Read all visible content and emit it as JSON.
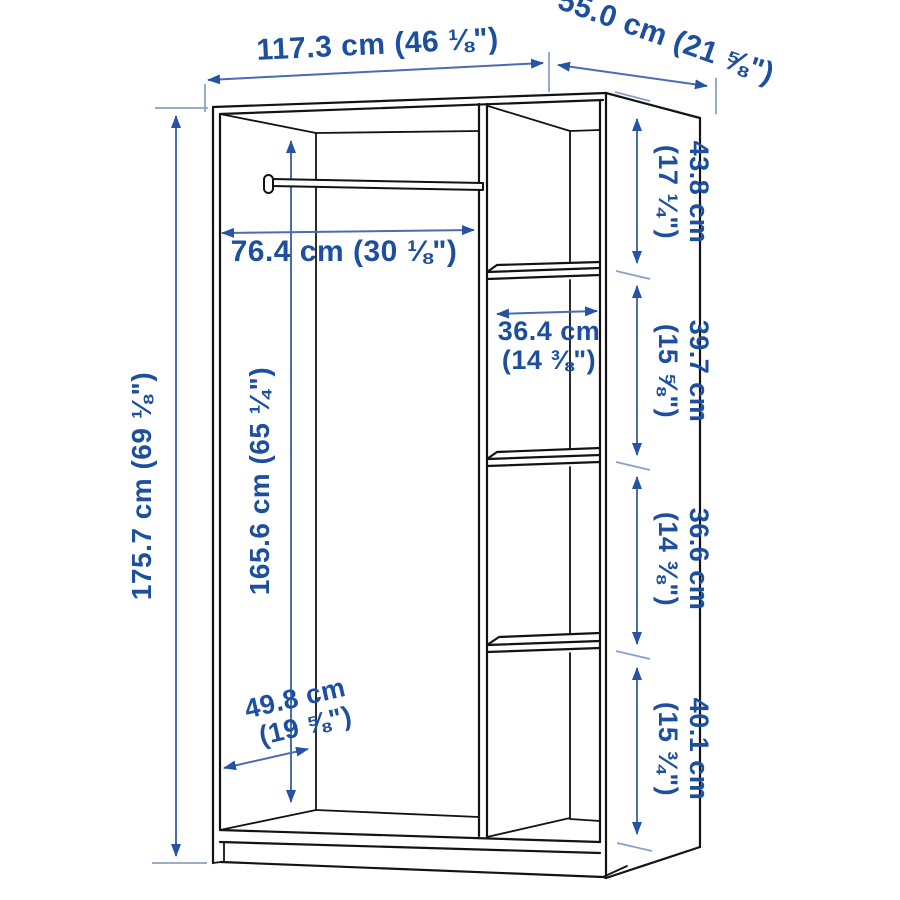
{
  "dimensions": {
    "width": "117.3 cm (46 ⅛\")",
    "depth": "55.0 cm (21 ⅝\")",
    "height": "175.7 cm (69 ⅛\")",
    "interior_height": "165.6 cm (65 ¼\")",
    "rod_width": "76.4 cm (30 ⅛\")",
    "shelf_width": {
      "value": "36.4 cm",
      "imperial": "(14 ⅜\")"
    },
    "interior_depth": {
      "value": "49.8 cm",
      "imperial": "(19 ⅝\")"
    },
    "side_segments": [
      {
        "value": "43.8 cm",
        "imperial": "(17 ¼\")"
      },
      {
        "value": "39.7 cm",
        "imperial": "(15 ⅝\")"
      },
      {
        "value": "36.6 cm",
        "imperial": "(14 ⅜\")"
      },
      {
        "value": "40.1 cm",
        "imperial": "(15 ¾\")"
      }
    ]
  },
  "colors": {
    "background": "#ffffff",
    "outline": "#131313",
    "dimension_line": "#4a6db2",
    "extension_line": "#8aa0cc",
    "arrow": "#2653a4",
    "label_text": "#1d4f9f"
  }
}
